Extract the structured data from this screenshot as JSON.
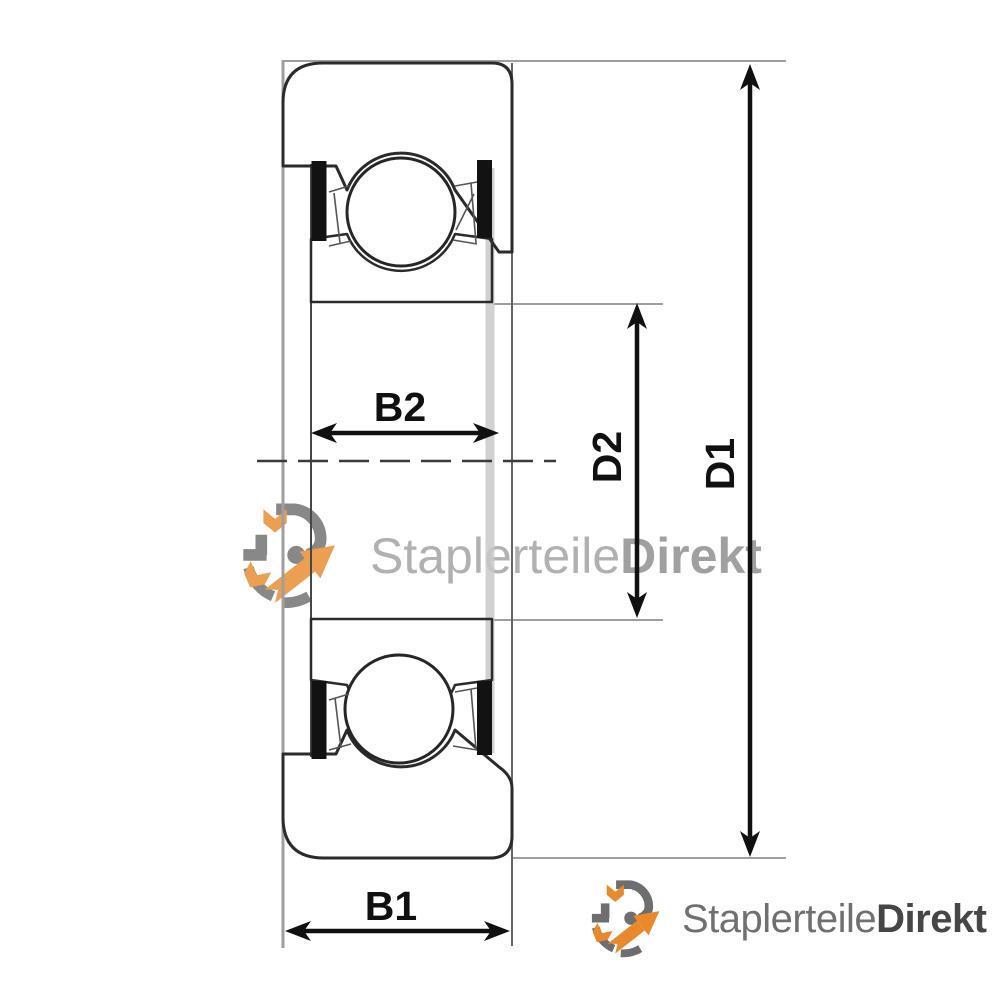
{
  "drawing": {
    "labels": {
      "b1": "B1",
      "b2": "B2",
      "d1": "D1",
      "d2": "D2"
    }
  },
  "watermark": {
    "brand_regular": "Staplerteile",
    "brand_bold": "Direkt"
  },
  "footer_logo": {
    "brand_regular": "Staplerteile",
    "brand_bold": "Direkt"
  },
  "colors": {
    "line_dark": "#2b2b2b",
    "line_mid": "#474747",
    "line_light": "#9f9f9f",
    "line_faint": "#c9c9c9",
    "dim_black": "#101010",
    "seal_black": "#121212",
    "logo_orange": "#e8892b",
    "logo_gray": "#6e6e6e",
    "footer_text_gray": "#707070",
    "footer_text_dark": "#464646",
    "watermark_text_gray": "#a0a0a0",
    "watermark_text_dark": "#8c8c8c"
  }
}
